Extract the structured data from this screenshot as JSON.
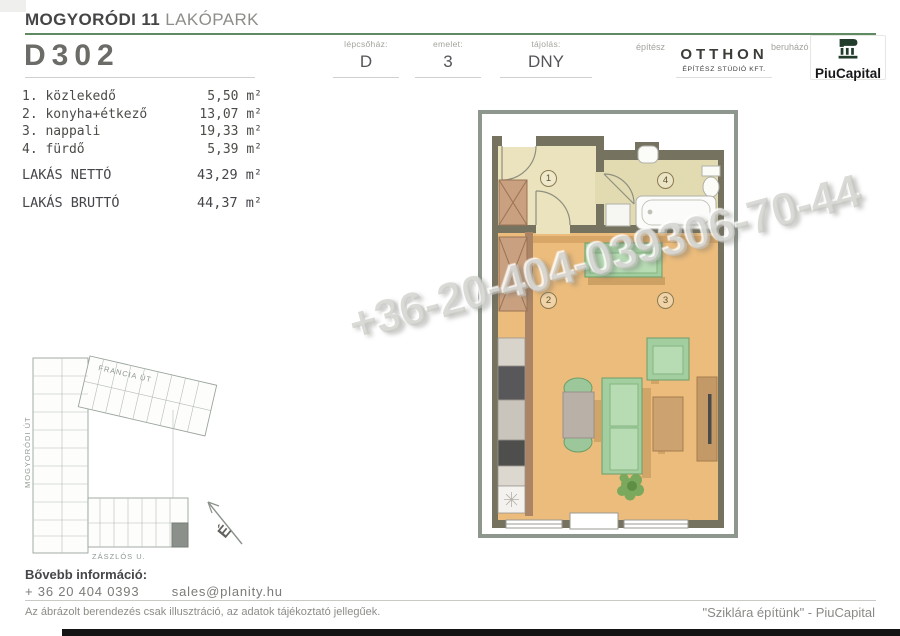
{
  "header": {
    "project_bold": "MOGYORÓDI 11",
    "project_light": "LAKÓPARK",
    "unit_id": "D302",
    "fields": [
      {
        "label": "lépcsőház:",
        "value": "D"
      },
      {
        "label": "emelet:",
        "value": "3"
      },
      {
        "label": "tájolás:",
        "value": "DNY"
      }
    ],
    "architect_label": "építész",
    "architect_name": "OTTHON",
    "architect_sub": "ÉPÍTÉSZ STÚDIÓ KFT.",
    "developer_label": "beruházó",
    "developer_name": "PiuCapital"
  },
  "rooms": {
    "items": [
      {
        "label": "1. közlekedő",
        "area": "5,50 m²"
      },
      {
        "label": "2. konyha+étkező",
        "area": "13,07 m²"
      },
      {
        "label": "3. nappali",
        "area": "19,33 m²"
      },
      {
        "label": "4. fürdő",
        "area": "5,39 m²"
      }
    ],
    "net_label": "LAKÁS NETTÓ",
    "net_area": "43,29 m²",
    "gross_label": "LAKÁS BRUTTÓ",
    "gross_area": "44,37 m²"
  },
  "plan": {
    "room_numbers": [
      "1",
      "2",
      "3",
      "4"
    ]
  },
  "site": {
    "street_top": "FRANCIA ÚT",
    "street_left": "MOGYORÓDI ÚT",
    "street_bottom": "ZÁSZLÓS U.",
    "compass_letter": "É"
  },
  "watermark": "+36-20-404-039306-70-44",
  "footer": {
    "info_label": "Bővebb információ:",
    "phone": "+ 36 20 404 0393",
    "email": "sales@planity.hu",
    "disclaimer": "Az ábrázolt berendezés csak illusztráció, az adatok tájékoztató jellegűek.",
    "slogan": "\"Sziklára építünk\" - PiuCapital"
  },
  "colors": {
    "accent_green": "#5f8a62",
    "logo_green": "#233d2d",
    "wood_floor": "#ecbc7c",
    "sofa_green": "#a3cfa0"
  }
}
